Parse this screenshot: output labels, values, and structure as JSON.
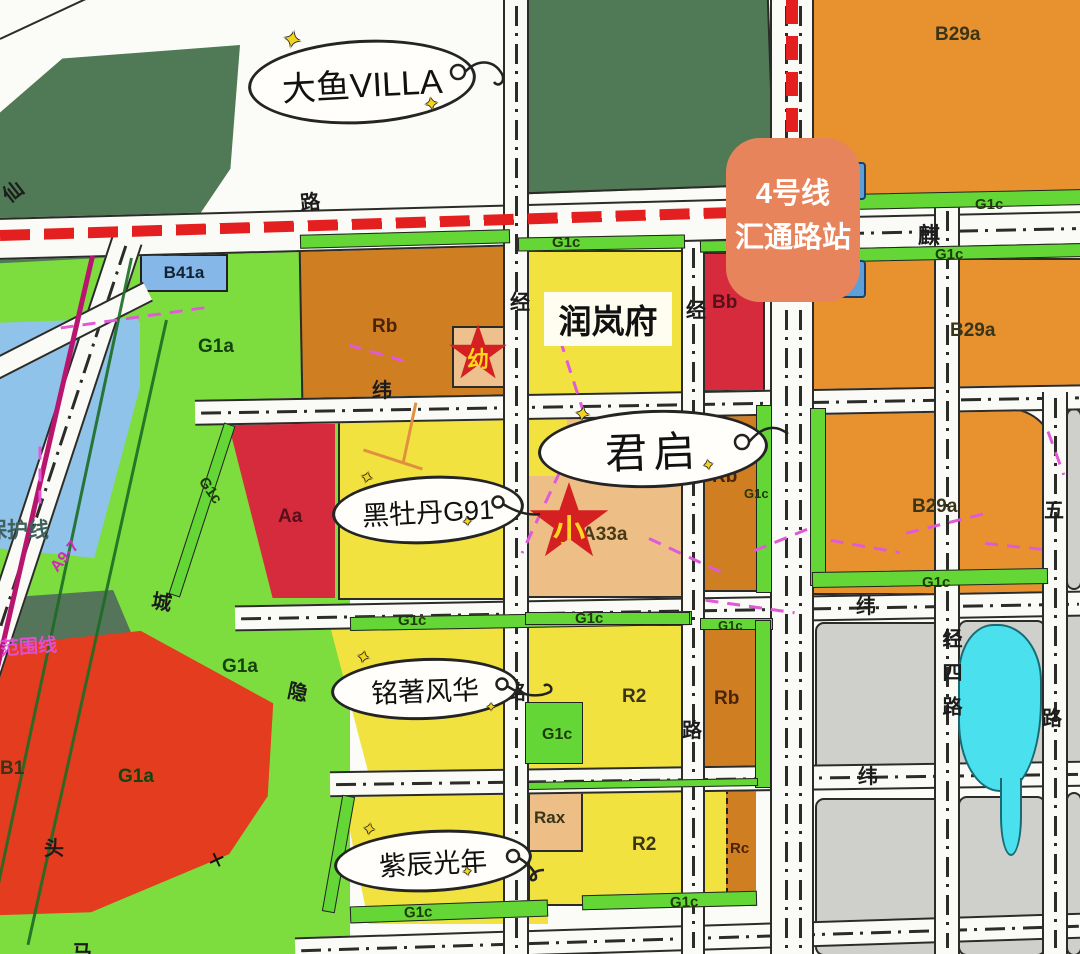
{
  "badge": {
    "line1": "4号线",
    "line2": "汇通路站"
  },
  "bubbles": {
    "dayu": "大鱼VILLA",
    "junqi": "君启",
    "heimudan": "黑牡丹G91",
    "mingzhu": "铭著风华",
    "zichen": "紫辰光年"
  },
  "label_box": {
    "runlanfu": "润岚府"
  },
  "stars": {
    "kindergarten": "幼",
    "primary": "小"
  },
  "station": {
    "exit": "2"
  },
  "codes": {
    "b29a": "B29a",
    "b41a": "B41a",
    "g1a": "G1a",
    "g1c": "G1c",
    "rb": "Rb",
    "bb": "Bb",
    "aa": "Aa",
    "a33a": "A33a",
    "r2": "R2",
    "rax": "Rax",
    "rc": "Rc",
    "b1": "B1",
    "a97": "A9-7"
  },
  "boundary_notes": {
    "baohuxian": "保护线",
    "fanweixian": "范围线"
  },
  "road_chars": {
    "xian": "仙",
    "lu": "路",
    "qi": "麒",
    "wei": "纬",
    "jing": "经",
    "cheng": "城",
    "yin": "隐",
    "tou": "头",
    "ma": "马",
    "wu": "五",
    "jingsilu": "经四路"
  },
  "colors": {
    "residential_yellow": "#f2e23f",
    "commercial_orange": "#e8912f",
    "business_brown": "#cf7e22",
    "public_red": "#d62b3c",
    "green_space": "#7ddd3f",
    "protective_green_strip": "#64d636",
    "forest_dark_green": "#4f7a55",
    "water_blue": "#8fc3ea",
    "pond_cyan": "#4ae0ee",
    "undeveloped_gray": "#cfcfcc",
    "school_tan": "#edbe86",
    "metro_line_red": "#e31f1f",
    "railway_magenta": "#b8156f",
    "boundary_magenta": "#e05ad8",
    "station_badge_salmon": "#e8845c",
    "station_exit_blue": "#5f9fd8"
  }
}
